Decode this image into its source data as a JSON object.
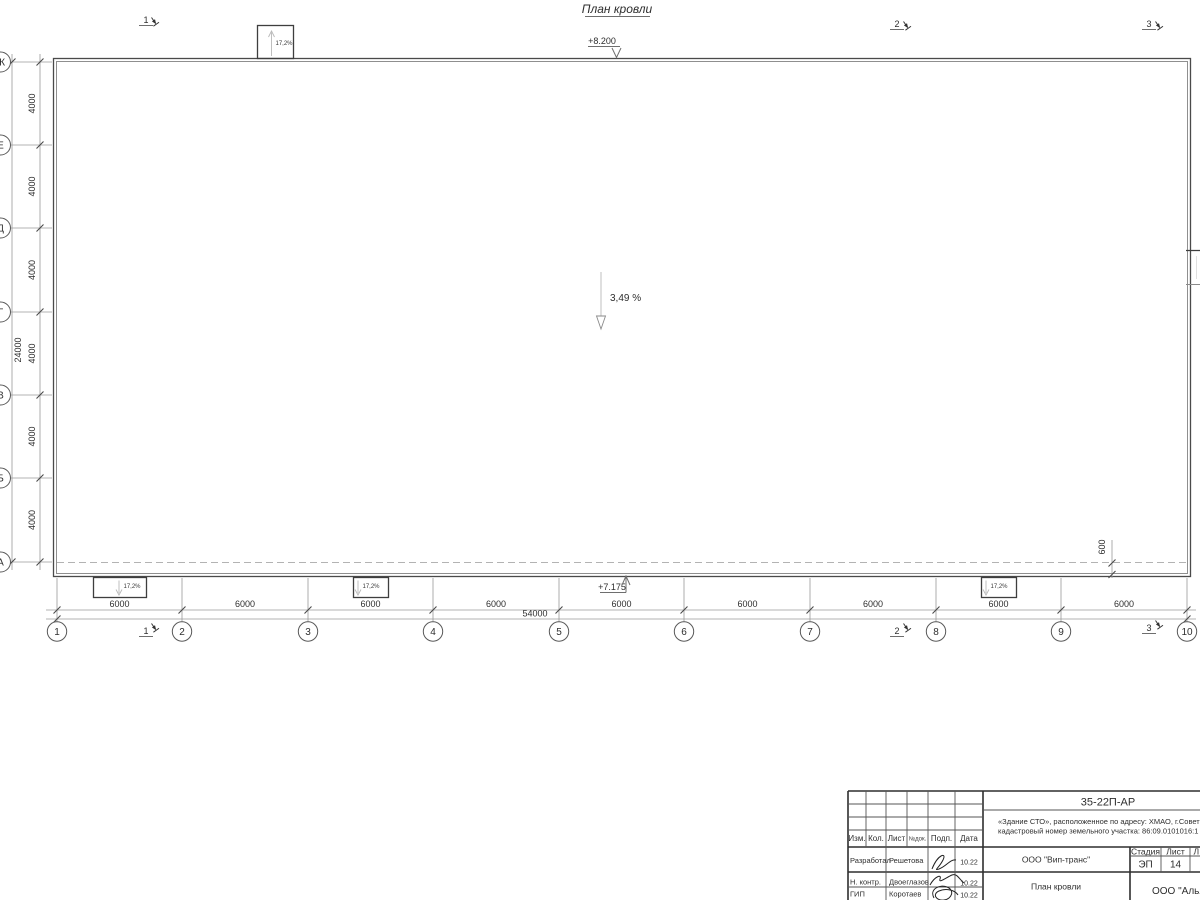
{
  "drawing_title": "План кровли",
  "elevations": {
    "roof_high": "+8.200",
    "roof_low": "+7.175"
  },
  "slopes": {
    "main": "3,49 %",
    "canopy": "17,2%"
  },
  "grid": {
    "columns": [
      "1",
      "2",
      "3",
      "4",
      "5",
      "6",
      "7",
      "8",
      "9",
      "10"
    ],
    "rows": [
      "Ж",
      "Е",
      "Д",
      "Г",
      "В",
      "Б",
      "А"
    ],
    "col_bays": [
      "6000",
      "6000",
      "6000",
      "6000",
      "6000",
      "6000",
      "6000",
      "6000",
      "6000"
    ],
    "row_bays": [
      "4000",
      "4000",
      "4000",
      "4000",
      "4000",
      "4000"
    ],
    "col_total": "54000",
    "row_total": "24000",
    "overhang": "600"
  },
  "section_marks": [
    "1",
    "2",
    "3"
  ],
  "titleblock": {
    "doc_code": "35-22П-АР",
    "project_line1": "«Здание СТО», расположенное по адресу: ХМАО, г.Совет",
    "project_line2": "кадастровый номер земельного участка: 86:09.0101016:1",
    "columns": [
      "Изм.",
      "Кол.",
      "Лист",
      "№док.",
      "Подп.",
      "Дата"
    ],
    "signers": [
      {
        "role": "Разработал",
        "name": "Решетова",
        "date": "10.22"
      },
      {
        "role": "Н. контр.",
        "name": "Двоеглазов",
        "date": "10.22"
      },
      {
        "role": "ГИП",
        "name": "Коротаев",
        "date": "10.22"
      }
    ],
    "org": "ООО \"Вип-транс\"",
    "sheet_name": "План кровли",
    "stage_label": "Стадия",
    "sheet_label": "Лист",
    "sheets_label": "Л",
    "stage": "ЭП",
    "sheet_number": "14",
    "org2": "ООО \"Алья"
  }
}
